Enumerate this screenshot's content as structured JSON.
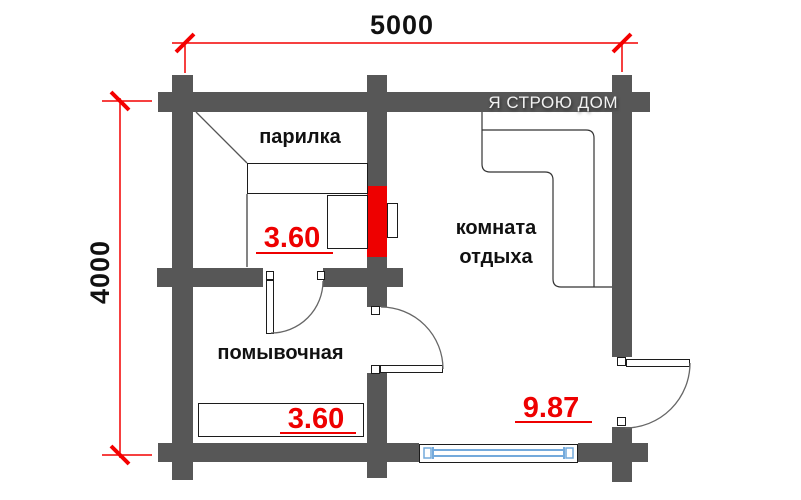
{
  "diagram": {
    "type": "bathhouse-floor-plan",
    "watermark": "Я СТРОЮ ДОМ",
    "dimensions": {
      "width_mm": "5000",
      "height_mm": "4000"
    },
    "rooms": [
      {
        "name": "парилка",
        "area": "3.60"
      },
      {
        "name": "помывочная",
        "area": "3.60"
      },
      {
        "name": "комната отдыха",
        "name_line1": "комната",
        "name_line2": "отдыха",
        "area": "9.87"
      }
    ],
    "colors": {
      "wall": "#575757",
      "stove": "#ee0000",
      "dimension_line": "#f40000",
      "area_label": "#ee0000",
      "window_glass": "#74aadc",
      "watermark_text": "#f2f2f2"
    },
    "features": {
      "stove": "дровяная печь (red firebox through partition)",
      "window": "window in bottom wall",
      "doors": 3,
      "benches": 2,
      "sofa": "L-shaped corner sofa"
    }
  }
}
